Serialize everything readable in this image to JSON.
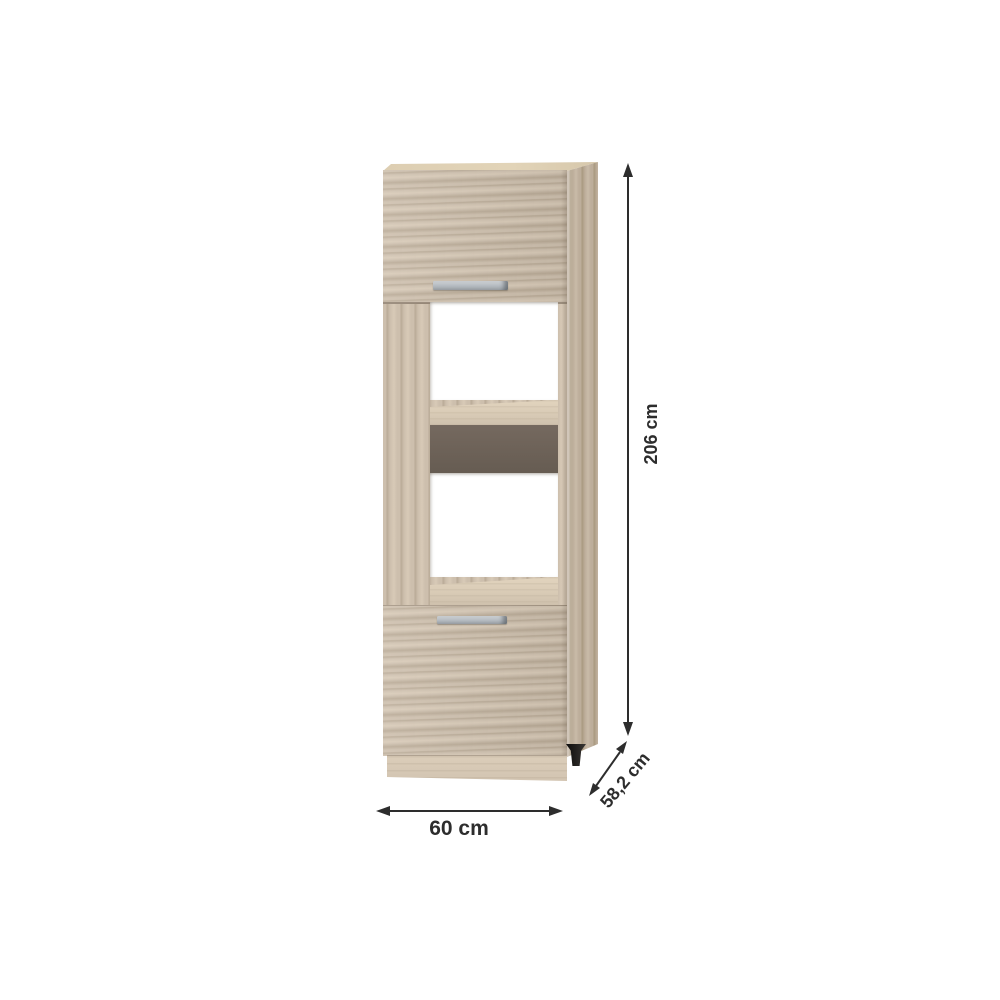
{
  "scene": {
    "type": "product-dimension-diagram",
    "background": "#ffffff"
  },
  "cabinet": {
    "kind": "tall kitchen oven-housing cabinet",
    "finish": "sonoma oak",
    "parts": [
      "top door",
      "upper open compartment",
      "middle shelf",
      "dark back panel strip",
      "lower open compartment",
      "bottom door",
      "plinth",
      "right side panel",
      "black adjustable foot"
    ],
    "handle_count": 2
  },
  "dimension_labels": {
    "height": "206 cm",
    "width": "60 cm",
    "depth": "58,2 cm"
  },
  "icons": {
    "height_arrow": "vertical-double-arrow",
    "width_arrow": "horizontal-double-arrow",
    "depth_arrow": "diagonal-double-arrow"
  },
  "colors": {
    "page_bg": "#ffffff",
    "wood_base": "#cdbfad",
    "wood_streak": "#b9aa96",
    "wood_light": "#d8cab7",
    "side_base": "#bdae9b",
    "side_streak": "#a9997f",
    "side_light": "#c9bba8",
    "top_surface": "#ddceb2",
    "shelf_surface": "#d9cbb6",
    "plinth": "#d2c4b1",
    "back_panel_dark": "#6b6158",
    "handle_silver_light": "#cfd3d6",
    "handle_silver_dark": "#9aa0a5",
    "foot_black": "#211f1d",
    "dimension_line": "#2d2d2d"
  }
}
